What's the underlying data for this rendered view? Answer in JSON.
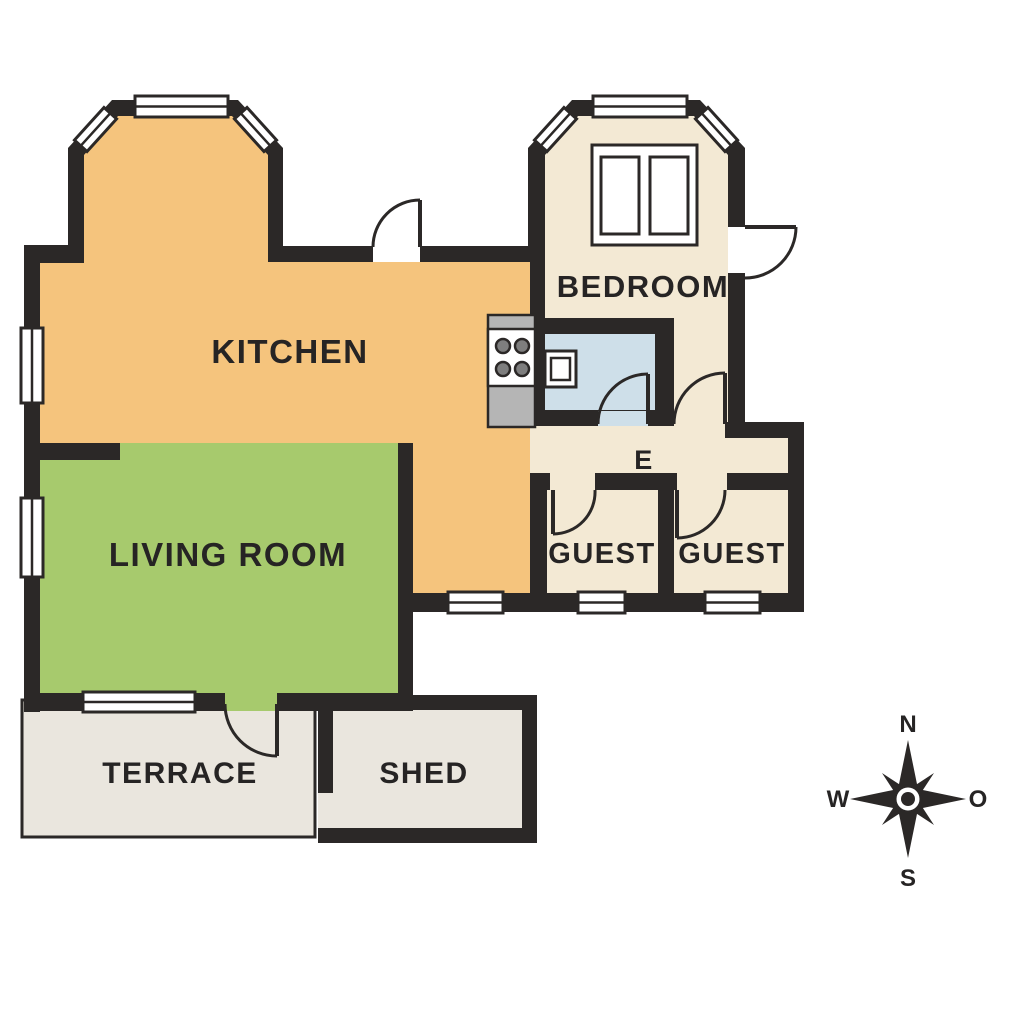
{
  "title": "House floor plan",
  "rooms": {
    "kitchen": {
      "label": "KITCHEN",
      "color": "#F5C47D"
    },
    "living_room": {
      "label": "LIVING ROOM",
      "color": "#A7CA6D"
    },
    "bedroom": {
      "label": "BEDROOM",
      "color": "#F3E9D4"
    },
    "bathroom": {
      "color": "#CEDFE9"
    },
    "hall": {
      "label": "E",
      "color": "#F3E9D4"
    },
    "guest_left": {
      "label": "GUEST",
      "color": "#F3E9D4"
    },
    "guest_right": {
      "label": "GUEST",
      "color": "#F3E9D4"
    },
    "terrace": {
      "label": "TERRACE",
      "color": "#EAE6DE"
    },
    "shed": {
      "label": "SHED",
      "color": "#EAE6DE"
    }
  },
  "compass": {
    "north": "N",
    "south": "S",
    "west": "W",
    "east": "O"
  },
  "palette": {
    "wall": "#2B2827",
    "label_text": "#262424",
    "window_fill": "#FFFFFF",
    "counter": "#B5B5B5",
    "burner": "#7E7E7E"
  }
}
